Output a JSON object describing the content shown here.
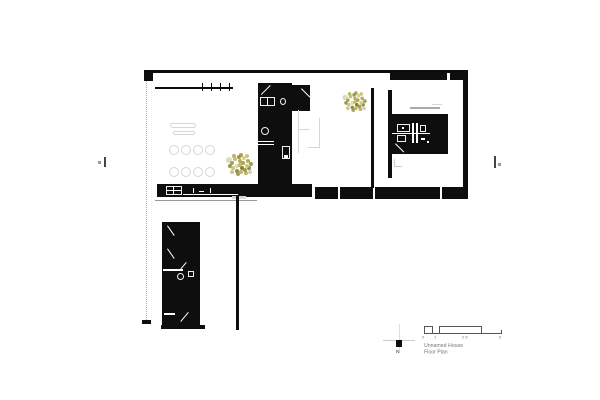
{
  "title_block": {
    "project_name": "Unnamed House",
    "drawing_name": "Floor Plan",
    "north_label": "N"
  },
  "scale_bar": {
    "unit_labels": [
      "0",
      "1",
      "2.5",
      "5"
    ]
  },
  "palette": {
    "paper": "#ffffff",
    "wall": "#0e0e0e",
    "furniture_line": "#d6d6d6",
    "annotation_gray": "#777777",
    "plant_olive": "#a8a355",
    "plant_yellow": "#d2c77b"
  },
  "icons": {
    "north_arrow": "crosshair-with-solid-square-pointer",
    "plant": "speckled-tree-canopy",
    "section_marker": "short-bar-with-dot",
    "stove": "four-burner-grid",
    "toilet": "circle-with-cistern-box"
  }
}
